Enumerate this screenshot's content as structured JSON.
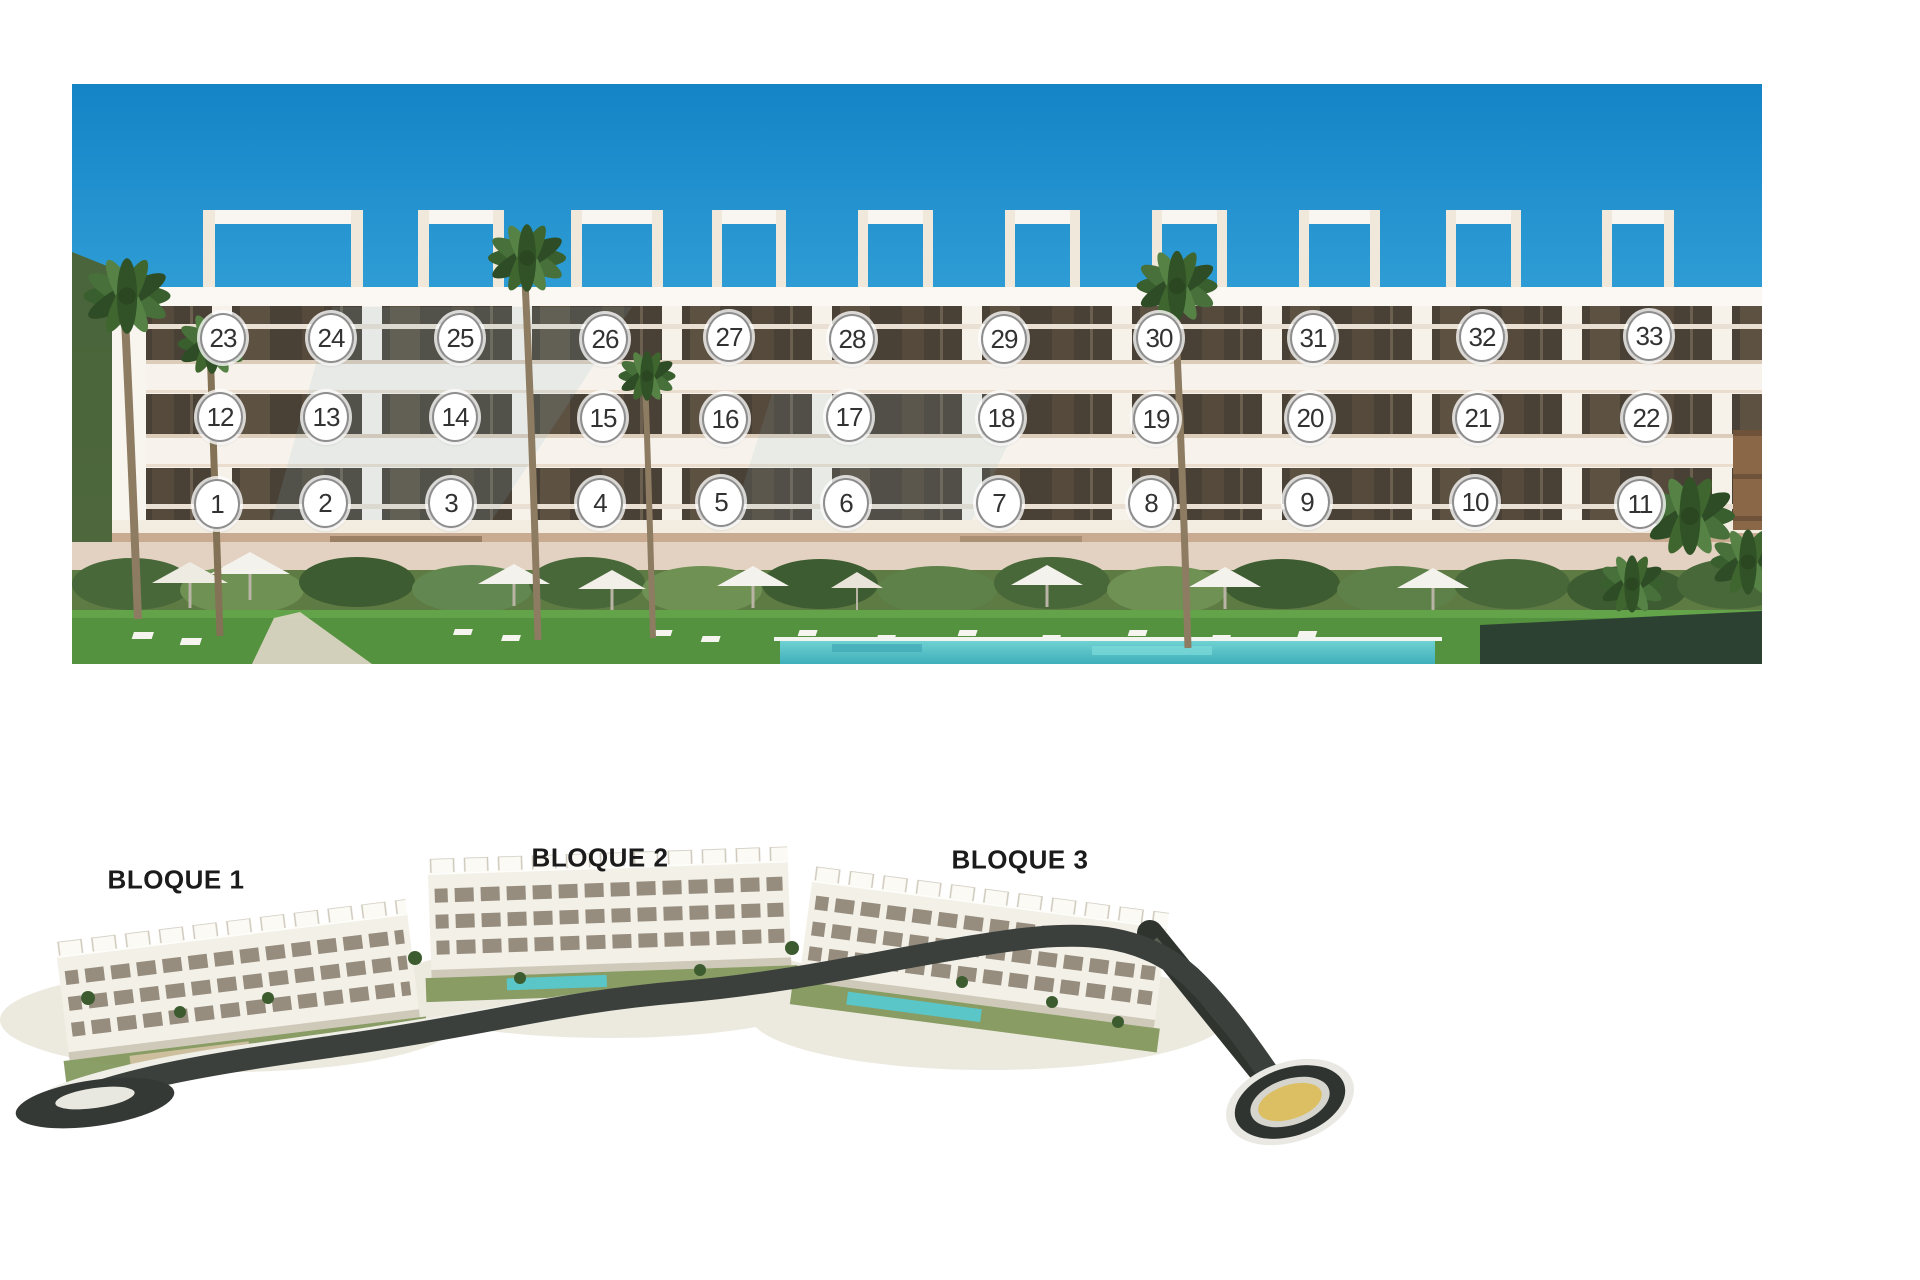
{
  "page": {
    "background": "#ffffff"
  },
  "elevation_render": {
    "position": {
      "x": 72,
      "y": 84,
      "width": 1690,
      "height": 580
    },
    "palette": {
      "sky_top": "#1484c7",
      "sky_mid": "#36a3d8",
      "sky_horizon": "#a7d6e8",
      "facade": "#f7f3ec",
      "glass": "#4a4136",
      "base_tan": "#c8ab90",
      "lawn": "#54923f",
      "pool": "#58c6c9",
      "hedge": "#2d4132",
      "wood_wall": "#8a6747",
      "vegetation": "#5d7b43"
    },
    "marker_style": {
      "fill": "#ffffff",
      "border": "#8e8e8e",
      "text_color": "#323232",
      "width": 42,
      "height": 46
    },
    "floors": [
      {
        "name": "floor-2",
        "units": [
          {
            "n": "23",
            "x": 221,
            "y": 336
          },
          {
            "n": "24",
            "x": 329,
            "y": 336
          },
          {
            "n": "25",
            "x": 458,
            "y": 336
          },
          {
            "n": "26",
            "x": 603,
            "y": 337
          },
          {
            "n": "27",
            "x": 727,
            "y": 335
          },
          {
            "n": "28",
            "x": 850,
            "y": 337
          },
          {
            "n": "29",
            "x": 1002,
            "y": 337
          },
          {
            "n": "30",
            "x": 1157,
            "y": 336
          },
          {
            "n": "31",
            "x": 1311,
            "y": 336
          },
          {
            "n": "32",
            "x": 1480,
            "y": 335
          },
          {
            "n": "33",
            "x": 1647,
            "y": 334
          }
        ]
      },
      {
        "name": "floor-1",
        "units": [
          {
            "n": "12",
            "x": 218,
            "y": 415
          },
          {
            "n": "13",
            "x": 324,
            "y": 415
          },
          {
            "n": "14",
            "x": 453,
            "y": 415
          },
          {
            "n": "15",
            "x": 601,
            "y": 416
          },
          {
            "n": "16",
            "x": 723,
            "y": 417
          },
          {
            "n": "17",
            "x": 847,
            "y": 415
          },
          {
            "n": "18",
            "x": 999,
            "y": 416
          },
          {
            "n": "19",
            "x": 1154,
            "y": 417
          },
          {
            "n": "20",
            "x": 1308,
            "y": 416
          },
          {
            "n": "21",
            "x": 1476,
            "y": 416
          },
          {
            "n": "22",
            "x": 1644,
            "y": 416
          }
        ]
      },
      {
        "name": "floor-0",
        "units": [
          {
            "n": "1",
            "x": 215,
            "y": 502
          },
          {
            "n": "2",
            "x": 323,
            "y": 501
          },
          {
            "n": "3",
            "x": 449,
            "y": 501
          },
          {
            "n": "4",
            "x": 598,
            "y": 501
          },
          {
            "n": "5",
            "x": 719,
            "y": 500
          },
          {
            "n": "6",
            "x": 844,
            "y": 501
          },
          {
            "n": "7",
            "x": 997,
            "y": 501
          },
          {
            "n": "8",
            "x": 1149,
            "y": 501
          },
          {
            "n": "9",
            "x": 1305,
            "y": 500
          },
          {
            "n": "10",
            "x": 1473,
            "y": 500
          },
          {
            "n": "11",
            "x": 1638,
            "y": 502
          }
        ]
      }
    ]
  },
  "site_plan_render": {
    "position": {
      "x": 0,
      "y": 830,
      "width": 1400,
      "height": 330
    },
    "label_color": "#1b1b1b",
    "road_color": "#3b403c",
    "roundabout": {
      "cx": 1290,
      "cy": 1102,
      "center_color": "#dcbf63",
      "ring_color": "#2f3431"
    },
    "blocks": [
      {
        "label": "BLOQUE 1",
        "cx": 176,
        "cy": 880
      },
      {
        "label": "BLOQUE 2",
        "cx": 600,
        "cy": 858
      },
      {
        "label": "BLOQUE 3",
        "cx": 1020,
        "cy": 860
      }
    ]
  }
}
